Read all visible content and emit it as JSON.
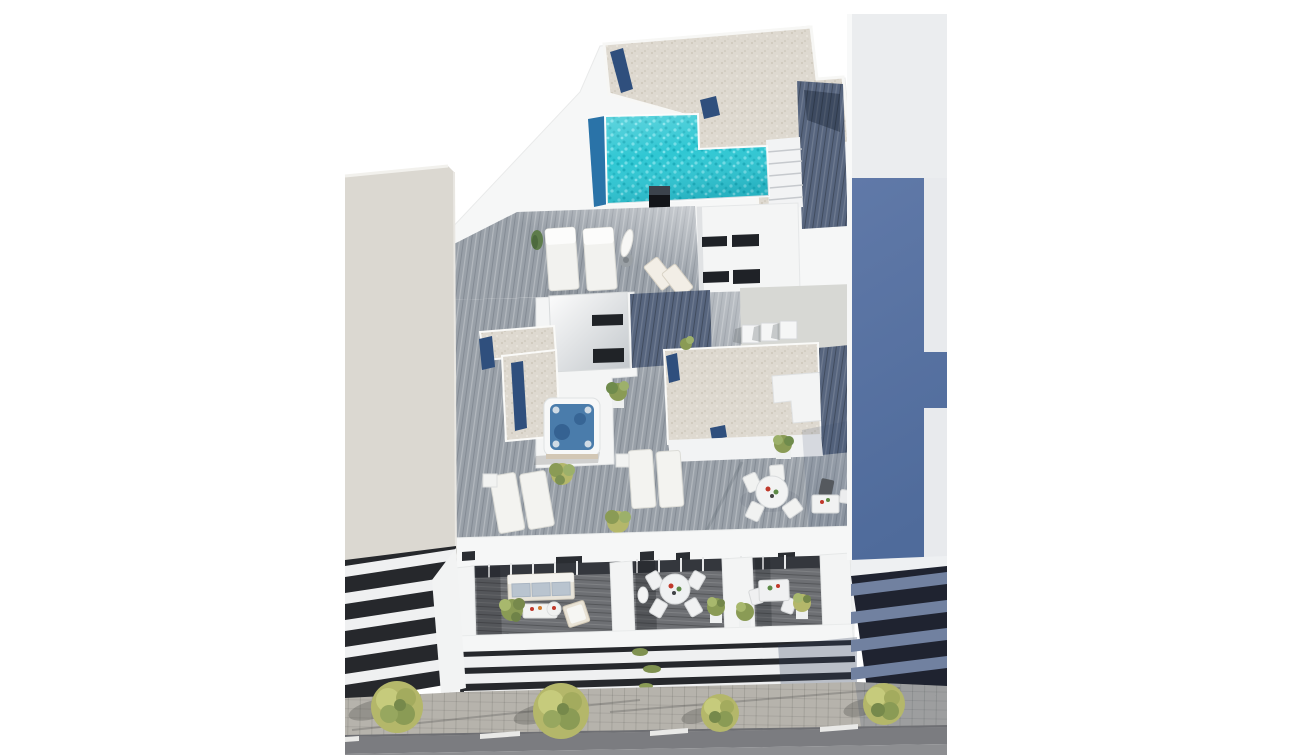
{
  "meta": {
    "description": "Aerial 3D architectural rendering of a modern residential building with an L-shaped rooftop pool, gravel roofs, a jacuzzi terrace with sun loungers, furnished balconies, neighbouring buildings and a tree-lined street",
    "view": "aerial isometric render, no text on screen"
  },
  "palette": {
    "pageBackground": "#ffffff",
    "offWhite": "#f6f7f7",
    "wallShade": "#e0e2e4",
    "leftWall": "#dbd8d1",
    "rightTop": "#ebedef",
    "rightShadow": "#5b76a4",
    "slatDark": "#26282c",
    "slatWhite": "#eff0f1",
    "slatBlue": "#7181a0",
    "gravel": "#ded9d0",
    "navy": "#2f4f7d",
    "pool": "#2fc7d3",
    "poolDeep": "#2a73a8",
    "jacuzzi": "#4a7cab",
    "deck": "#99a0a8",
    "deckDark": "#57657e",
    "paleDeck": "#d7d8d4",
    "balconyFloor": "#6d6f73",
    "glass": "#34373d",
    "chimney": "#131519",
    "sidewalk": "#b6b3ac",
    "roadBand": "#7b7c80",
    "road": "#8d8e91",
    "treeOlive": "#b4b76a",
    "treeGreen": "#8a9b55",
    "treeLight": "#c6cb7c",
    "treeDark": "#76894b",
    "accentRed": "#c0392b",
    "accentGreen": "#5d8a46"
  },
  "scene": {
    "rooftop": {
      "pool": "L-shaped turquoise swimming pool with dark blue edge lane",
      "roof_finish": "white gravel roof with navy skylight strips",
      "stairs": "white staircase beside the pool",
      "service_shaft": "black chimney block",
      "upper_terrace_items": [
        "double sun bed",
        "double sun bed",
        "closed parasol",
        "folding deck chair",
        "folding deck chair",
        "conical shrub"
      ]
    },
    "mid_terrace": {
      "hot_tub": "square spa with blue water",
      "sun_loungers": 4,
      "dining": "round white table with four chairs, dark chair and side table",
      "roof_boxes": "stairwell volume with dark vent slots, gravel roofs with navy glass strips, rooftop units",
      "plants": "potted green shrubs"
    },
    "balconies": {
      "left": [
        "three-seat sofa with blue cushions",
        "coffee table",
        "round side table",
        "cushioned lounge chair",
        "leafy plant"
      ],
      "middle": [
        "round dining table",
        "four white chairs",
        "white sculpture",
        "potted shrub"
      ],
      "right": [
        "rectangular dining table",
        "two chairs",
        "potted shrub",
        "potted shrub"
      ]
    },
    "lower_floors": "stacked white balcony slabs with dark recesses and trailing greenery",
    "street": {
      "trees": 4,
      "sidewalk": "paved, with long cast shadows",
      "road": "asphalt with white dashed line"
    },
    "neighbours": {
      "left": "beige building with horizontal balcony slats",
      "right": "tall block in blue shadow with stepped facade and blue balcony slats"
    }
  }
}
